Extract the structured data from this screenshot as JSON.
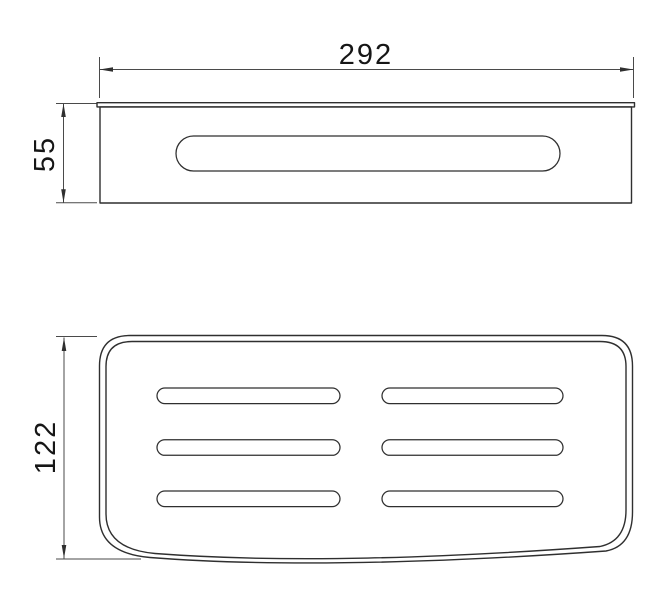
{
  "drawing": {
    "front_view": {
      "width_dimension": "292",
      "height_dimension": "55"
    },
    "plan_view": {
      "depth_dimension": "122"
    },
    "colors": {
      "outline": "#2f2f2f",
      "dimension_line": "#4a4a4a",
      "text": "#161616",
      "background": "#ffffff"
    }
  }
}
